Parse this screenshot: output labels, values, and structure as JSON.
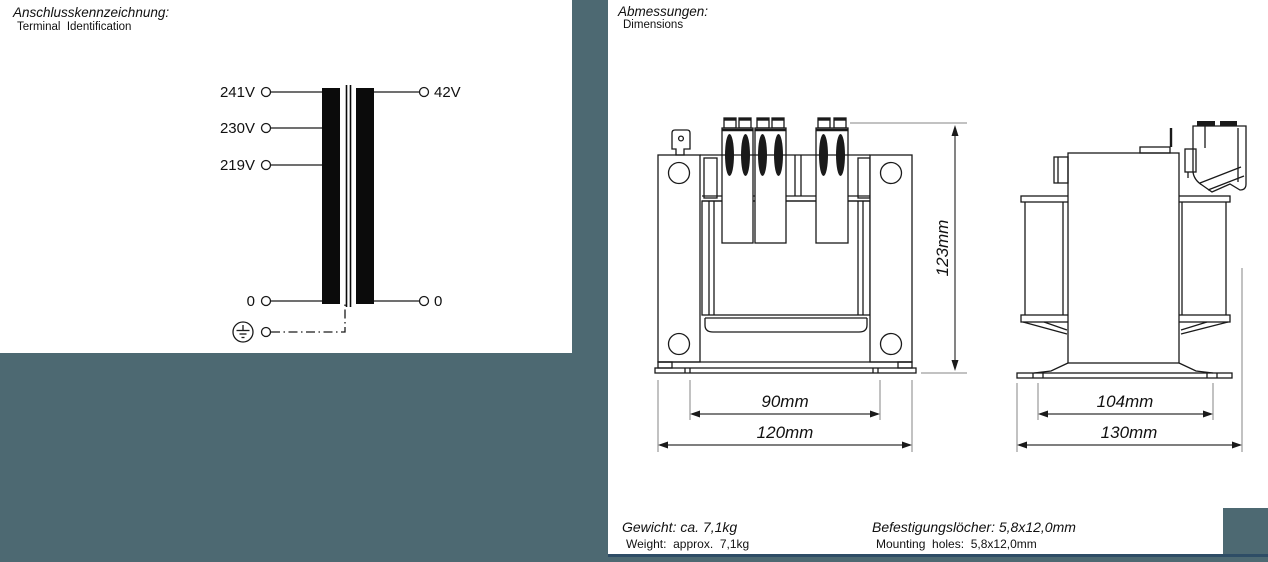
{
  "colors": {
    "background": "#4d6972",
    "panel": "#ffffff",
    "accent_bar": "#2e4d66",
    "line": "#1a1a1a"
  },
  "terminal_panel": {
    "title_de": "Anschlusskennzeichnung:",
    "title_en": "Terminal  Identification",
    "primary_taps": [
      "241V",
      "230V",
      "219V",
      "0"
    ],
    "secondary_taps": [
      "42V",
      "0"
    ]
  },
  "dimensions_panel": {
    "title_de": "Abmessungen:",
    "title_en": "Dimensions",
    "front_view": {
      "height": "123mm",
      "inner_width": "90mm",
      "outer_width": "120mm"
    },
    "side_view": {
      "inner_width": "104mm",
      "outer_width": "130mm"
    }
  },
  "footer": {
    "weight_de": "Gewicht: ca. 7,1kg",
    "weight_en": "Weight:  approx.  7,1kg",
    "holes_de": "Befestigungslöcher: 5,8x12,0mm",
    "holes_en": "Mounting  holes:  5,8x12,0mm"
  }
}
